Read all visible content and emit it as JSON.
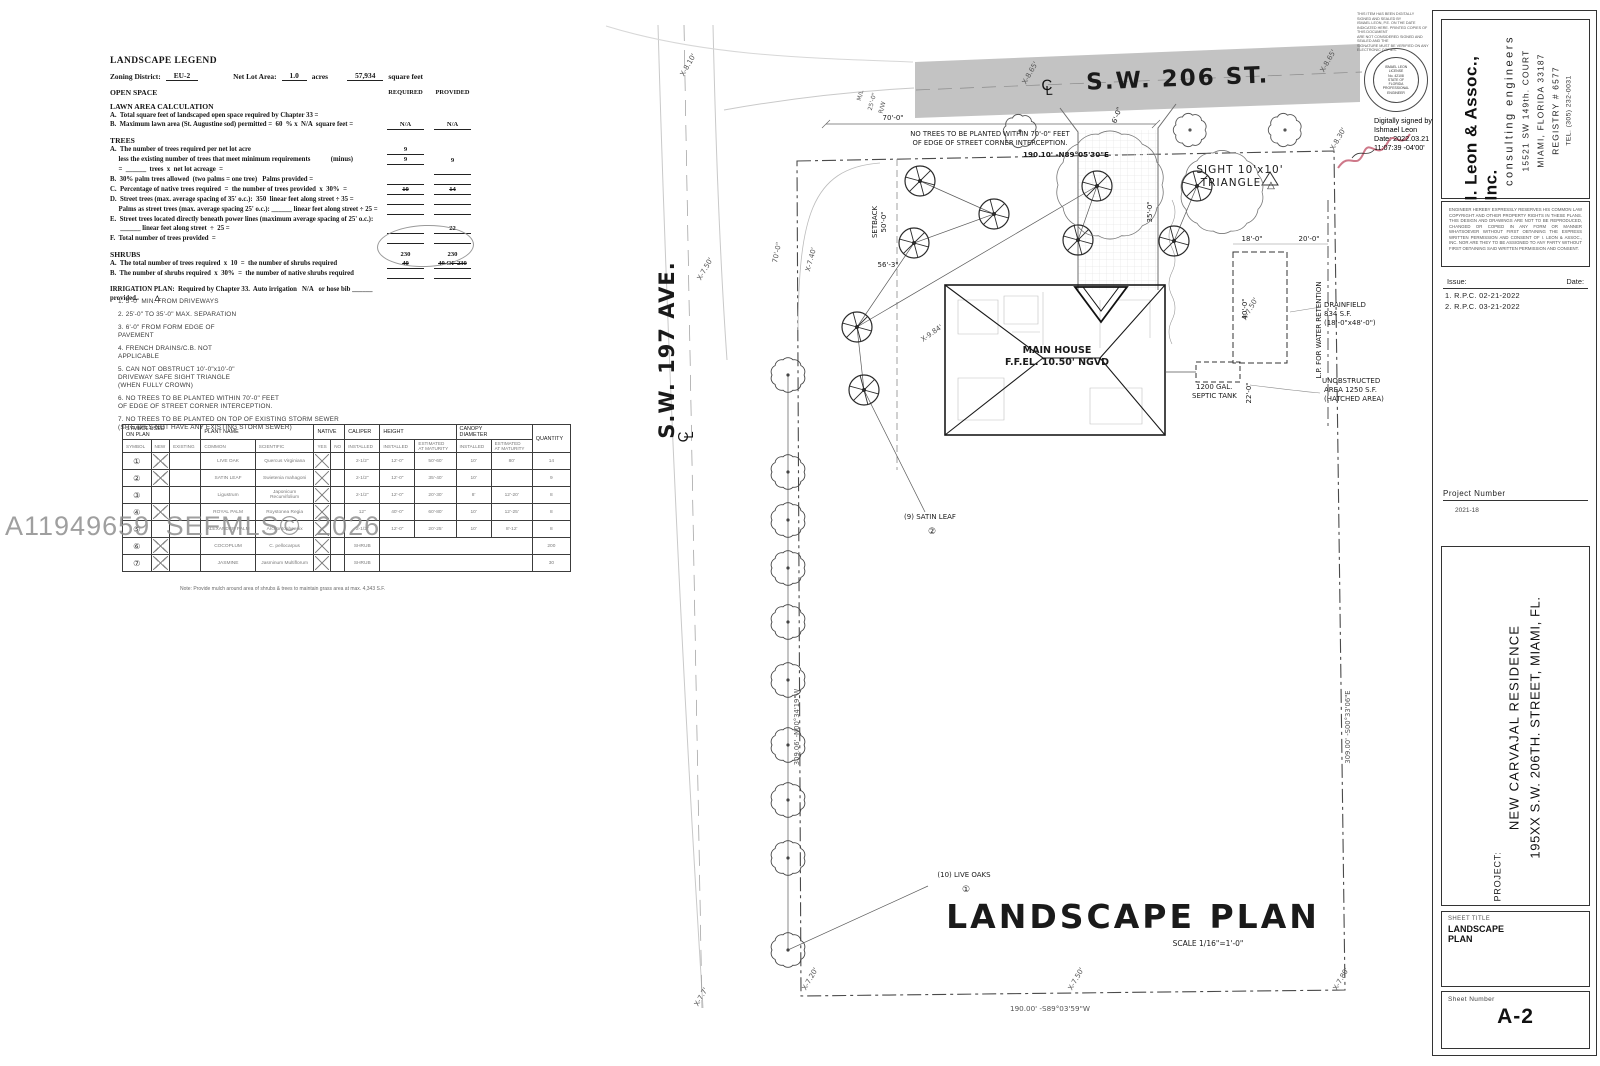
{
  "watermark": "A11949659  SEFMLS© 2026",
  "legend": {
    "title": "LANDSCAPE LEGEND",
    "zoning_label": "Zoning District:",
    "zoning_value": "EU-2",
    "netlot_label": "Net Lot Area:",
    "netlot_acres": "1.0",
    "acres_word": "acres",
    "netlot_sf": "57,934",
    "sf_word": "square feet",
    "rows": [
      {
        "t": "OPEN SPACE",
        "h": 1,
        "hdrR": "REQUIRED",
        "hdrP": "PROVIDED"
      },
      {
        "sp": 5
      },
      {
        "t": "LAWN AREA CALCULATION",
        "h": 1
      },
      {
        "t": "A.  Total square feet of landscaped open space required by Chapter 33 ="
      },
      {
        "t": "B.  Maximum lawn area (St. Augustine sod) permitted =  60  % x  N/A  square feet =",
        "r": "N/A",
        "rl": 1,
        "p": "N/A",
        "pl": 1
      },
      {
        "sp": 6
      },
      {
        "t": "TREES",
        "h": 1
      },
      {
        "t": "A.  The number of trees required per net lot acre",
        "r": "9",
        "rl": 1
      },
      {
        "t": "     less the existing number of trees that meet minimum requirements            (minus)",
        "r": "9",
        "rl": 1,
        "p": "9"
      },
      {
        "t": "     =  ______  trees  x  net lot acreage  =",
        "pl": 1
      },
      {
        "t": "B.  30% palm trees allowed  (two palms = one tree)   Palms provided =",
        "rl": 1,
        "pl": 1
      },
      {
        "t": "C.  Percentage of native trees required  =  the number of trees provided  x  30%  =",
        "r": "10",
        "rl": 1,
        "rs": 1,
        "p": "14",
        "pl": 1,
        "ps": 1
      },
      {
        "t": "D.  Street trees (max. average spacing of 35' o.c.):  350  linear feet along street ÷ 35 =",
        "rl": 1,
        "pl": 1
      },
      {
        "t": "     Palms as street trees (max. average spacing 25' o.c.): ______ linear feet along street ÷ 25 =",
        "rl": 1,
        "pl": 1
      },
      {
        "t": "E.  Street trees located directly beneath power lines (maximum average spacing of 25' o.c.):"
      },
      {
        "t": "      ______ linear feet along street  ÷  25 =",
        "rl": 1,
        "p": "22",
        "pl": 1
      },
      {
        "t": "F.  Total number of trees provided  =",
        "rl": 1,
        "pl": 1
      },
      {
        "sp": 6
      },
      {
        "t": "SHRUBS",
        "h": 1,
        "r": "230",
        "p": "230"
      },
      {
        "t": "A.  The total number of trees required  x  10  =  the number of shrubs required",
        "r": "40",
        "rl": 1,
        "rs": 1,
        "p": "40 OF 230",
        "pl": 1,
        "ps": 1
      },
      {
        "t": "B.  The number of shrubs required  x  30%  =  the number of native shrubs required",
        "rl": 1,
        "pl": 1
      },
      {
        "sp": 6
      },
      {
        "t": "IRRIGATION PLAN:  Required by Chapter 33.  Auto irrigation   N/A   or hose bib ______ provided.          △"
      }
    ]
  },
  "notes": [
    "1. 5'-0\" MIN. FROM DRIVEWAYS",
    "2. 25'-0\" TO 35'-0\" MAX. SEPARATION",
    "3. 6'-0\" FROM FORM EDGE OF\nPAVEMENT",
    "4. FRENCH DRAINS/C.B. NOT\nAPPLICABLE",
    "5. CAN NOT OBSTRUCT 10'-0\"x10'-0\"\nDRIVEWAY SAFE SIGHT TRIANGLE\n(WHEN FULLY CROWN)",
    "6. NO TREES TO BE PLANTED WITHIN 70'-0\" FEET\nOF EDGE OF STREET CORNER INTERCEPTION.",
    "7. NO TREES TO BE PLANTED ON TOP OF EXISTING STORM SEWER\n(SITE DIES NOT HAVE ANY EXISTING STORM SEWER)"
  ],
  "plant_table": {
    "groups": [
      {
        "l": "SYMBOL USED\nON PLAN",
        "c": 3
      },
      {
        "l": "PLANT NAME",
        "c": 2
      },
      {
        "l": "NATIVE",
        "c": 2
      },
      {
        "l": "CALIPER",
        "c": 1
      },
      {
        "l": "HEIGHT",
        "c": 2
      },
      {
        "l": "CANOPY\nDIAMETER",
        "c": 2
      },
      {
        "l": "QUANTITY",
        "c": 1,
        "rs": 2
      }
    ],
    "subheaders": [
      "SYMBOL",
      "NEW",
      "EXISTING",
      "COMMON",
      "SCIENTIFIC",
      "YES",
      "NO",
      "INSTALLED",
      "INSTALLED",
      "ESTIMATED\nAT MATURITY",
      "INSTALLED",
      "ESTIMATED\nAT MATURITY"
    ],
    "rows": [
      [
        "①",
        "X",
        "",
        "LIVE OAK",
        "Quercus Virginiana",
        "X",
        "",
        "2-1/2\"",
        "12'-0\"",
        "50'-60'",
        "10'",
        "80'",
        "14"
      ],
      [
        "②",
        "X",
        "",
        "SATIN LEAF",
        "Swietenia mahagoni",
        "X",
        "",
        "2-1/2\"",
        "12'-0\"",
        "35'-40'",
        "10'",
        "",
        "9"
      ],
      [
        "③",
        "",
        "",
        "Ligustrum",
        "Japonicum\nRecurvifolium",
        "X",
        "",
        "2-1/2\"",
        "12'-0\"",
        "20'-30'",
        "8'",
        "12'-20'",
        "8"
      ],
      [
        "④",
        "X",
        "",
        "ROYAL PALM",
        "Roystonea Regia",
        "X",
        "",
        "12\"",
        "40'-0\"",
        "60'-80'",
        "10'",
        "12'-25'",
        "8"
      ],
      [
        "⑤",
        "",
        "",
        "ALEXANDER PALM",
        "Archontophoenix",
        "X",
        "",
        "2-1/2\"",
        "12'-0\"",
        "20'-25'",
        "10'",
        "8'-12'",
        "8"
      ],
      [
        "⑥",
        "X",
        "",
        "COCOPLUM",
        "C. pellocarpus",
        "X",
        "",
        "SHRUB",
        "",
        "",
        "",
        "",
        "200"
      ],
      [
        "⑦",
        "X",
        "",
        "JASMINE",
        "Jasminum Multiflorum",
        "X",
        "",
        "SHRUB",
        "",
        "",
        "",
        "",
        "30"
      ]
    ],
    "note": "Note: Provide mulch around area of shrubs & trees to maintain grass area at max. 4,343 S.F."
  },
  "plan": {
    "labels": [
      {
        "t": "S.W. 206 ST.",
        "x": 1178,
        "y": 86,
        "s": 23,
        "w": 700,
        "ls": 2,
        "r": -2.3
      },
      {
        "t": "S.W. 197 AVE.",
        "x": 674,
        "y": 350,
        "s": 21,
        "w": 700,
        "ls": 1,
        "r": -90
      },
      {
        "t": "190.10' -N89°05'30\"E",
        "x": 1066,
        "y": 157,
        "s": 7.2,
        "w": 700
      },
      {
        "t": "309.06' -N00°34'19\"W",
        "x": 799,
        "y": 727,
        "s": 6.8,
        "r": -90,
        "f": "#555"
      },
      {
        "t": "309.00' -S00°33'06\"E",
        "x": 1350,
        "y": 727,
        "s": 6.8,
        "r": -90,
        "f": "#555"
      },
      {
        "t": "190.00' -S89°03'59\"W",
        "x": 1050,
        "y": 1011,
        "s": 7.2,
        "f": "#555"
      },
      {
        "t": "NO TREES TO BE PLANTED WITHIN 70'-0\" FEET",
        "x": 990,
        "y": 136,
        "s": 6.8
      },
      {
        "t": "OF EDGE OF STREET CORNER INTERCEPTION.",
        "x": 990,
        "y": 145,
        "s": 6.8
      },
      {
        "t": "70'-0\"",
        "x": 893,
        "y": 120,
        "s": 7
      },
      {
        "t": "SIGHT 10'x10'",
        "x": 1240,
        "y": 173,
        "s": 10.5,
        "ls": 1
      },
      {
        "t": "TRIANGLE",
        "x": 1231,
        "y": 186,
        "s": 10.5,
        "ls": 1
      },
      {
        "t": "△",
        "x": 1271,
        "y": 188,
        "s": 10
      },
      {
        "t": "MAIN HOUSE",
        "x": 1057,
        "y": 353,
        "s": 9.5,
        "w": 700
      },
      {
        "t": "F.F.EL. 10.50' NGVD",
        "x": 1057,
        "y": 365,
        "s": 9.5,
        "w": 700
      },
      {
        "t": "DRAINFIELD",
        "x": 1324,
        "y": 307,
        "s": 7,
        "a": "start"
      },
      {
        "t": "834 S.F.",
        "x": 1324,
        "y": 316,
        "s": 7,
        "a": "start"
      },
      {
        "t": "(18'-0\"x48'-0\")",
        "x": 1324,
        "y": 325,
        "s": 7,
        "a": "start"
      },
      {
        "t": "L.P. FOR WATER RETENTION",
        "x": 1321,
        "y": 330,
        "s": 7,
        "r": -90
      },
      {
        "t": "1200 GAL.",
        "x": 1196,
        "y": 389,
        "s": 7,
        "a": "start"
      },
      {
        "t": "SEPTIC TANK",
        "x": 1192,
        "y": 398,
        "s": 7,
        "a": "start"
      },
      {
        "t": "UNOBSTRUCTED",
        "x": 1322,
        "y": 383,
        "s": 7,
        "a": "start"
      },
      {
        "t": "AREA 1250 S.F.",
        "x": 1324,
        "y": 392,
        "s": 7,
        "a": "start"
      },
      {
        "t": "(HATCHED AREA)",
        "x": 1324,
        "y": 401,
        "s": 7,
        "a": "start"
      },
      {
        "t": "(9) SATIN LEAF",
        "x": 930,
        "y": 519,
        "s": 7
      },
      {
        "t": "②",
        "x": 932,
        "y": 534,
        "s": 9
      },
      {
        "t": "(10) LIVE OAKS",
        "x": 964,
        "y": 877,
        "s": 7
      },
      {
        "t": "①",
        "x": 966,
        "y": 892,
        "s": 9
      },
      {
        "t": "LANDSCAPE PLAN",
        "x": 1133,
        "y": 928,
        "s": 33,
        "w": 700,
        "ls": 3
      },
      {
        "t": "SCALE 1/16\"=1'-0\"",
        "x": 1208,
        "y": 946,
        "s": 7.5
      },
      {
        "t": "X-8.10'",
        "x": 690,
        "y": 66,
        "s": 7,
        "r": -60,
        "f": "#555"
      },
      {
        "t": "X-8.65'",
        "x": 1032,
        "y": 74,
        "s": 7,
        "r": -60,
        "f": "#555"
      },
      {
        "t": "X-8.65'",
        "x": 1330,
        "y": 62,
        "s": 7,
        "r": -60,
        "f": "#555"
      },
      {
        "t": "X-8.30'",
        "x": 1340,
        "y": 140,
        "s": 7,
        "r": -60,
        "f": "#555"
      },
      {
        "t": "X-7.50'",
        "x": 707,
        "y": 270,
        "s": 7,
        "r": -60,
        "f": "#555"
      },
      {
        "t": "X-7.40'",
        "x": 813,
        "y": 260,
        "s": 7,
        "r": -75,
        "f": "#555"
      },
      {
        "t": "X-9.84'",
        "x": 933,
        "y": 335,
        "s": 7,
        "r": -35,
        "f": "#555"
      },
      {
        "t": "X-7.50'",
        "x": 1252,
        "y": 310,
        "s": 7,
        "r": -60,
        "f": "#555"
      },
      {
        "t": "X-7.7'",
        "x": 703,
        "y": 998,
        "s": 7,
        "r": -60,
        "f": "#555"
      },
      {
        "t": "X-7.20'",
        "x": 812,
        "y": 980,
        "s": 7,
        "r": -60,
        "f": "#555"
      },
      {
        "t": "X-7.50'",
        "x": 1078,
        "y": 980,
        "s": 7,
        "r": -60,
        "f": "#555"
      },
      {
        "t": "X-7.80'",
        "x": 1343,
        "y": 980,
        "s": 7,
        "r": -60,
        "f": "#555"
      },
      {
        "t": "56'-3\"",
        "x": 888,
        "y": 267,
        "s": 7
      },
      {
        "t": "50'-0\"",
        "x": 886,
        "y": 222,
        "s": 7,
        "r": -90
      },
      {
        "t": "SETBACK",
        "x": 877,
        "y": 222,
        "s": 7,
        "r": -90
      },
      {
        "t": "70'-0\"",
        "x": 779,
        "y": 253,
        "s": 7,
        "r": -78,
        "f": "#555"
      },
      {
        "t": "35'-0\"",
        "x": 1152,
        "y": 212,
        "s": 7,
        "r": -90
      },
      {
        "t": "6'-0\"",
        "x": 1119,
        "y": 116,
        "s": 7,
        "r": -70
      },
      {
        "t": "M/L",
        "x": 862,
        "y": 96,
        "s": 6,
        "r": -75,
        "f": "#555"
      },
      {
        "t": "25'-0\"",
        "x": 874,
        "y": 102,
        "s": 6,
        "r": -75,
        "f": "#555"
      },
      {
        "t": "R/W",
        "x": 884,
        "y": 108,
        "s": 6,
        "r": -75,
        "f": "#555"
      },
      {
        "t": "18'-0\"",
        "x": 1252,
        "y": 241,
        "s": 7
      },
      {
        "t": "20'-0\"",
        "x": 1309,
        "y": 241,
        "s": 7
      },
      {
        "t": "40'-0\"",
        "x": 1247,
        "y": 309,
        "s": 7,
        "r": -90
      },
      {
        "t": "22'-0\"",
        "x": 1251,
        "y": 393,
        "s": 7,
        "r": -90
      }
    ],
    "cl_symbols": [
      [
        1047,
        90,
        -2
      ],
      [
        688,
        437,
        -90
      ]
    ],
    "satin_leaf_positions": [
      [
        920,
        181
      ],
      [
        994,
        214
      ],
      [
        914,
        243
      ],
      [
        857,
        327
      ],
      [
        864,
        390
      ],
      [
        1097,
        186
      ],
      [
        1197,
        186
      ],
      [
        1078,
        240
      ],
      [
        1174,
        241
      ]
    ],
    "live_oak_positions": [
      [
        788,
        375
      ],
      [
        788,
        472
      ],
      [
        788,
        520
      ],
      [
        788,
        568
      ],
      [
        788,
        622
      ],
      [
        788,
        680
      ],
      [
        788,
        745
      ],
      [
        788,
        800
      ],
      [
        788,
        858
      ],
      [
        788,
        950
      ]
    ],
    "existing_tree_positions": [
      [
        1020,
        131
      ],
      [
        1190,
        130
      ],
      [
        1285,
        130
      ]
    ],
    "canopy_clouds": [
      [
        1110,
        185,
        52
      ],
      [
        1222,
        192,
        40
      ]
    ]
  },
  "titleblock": {
    "company": {
      "name": "I. Leon & Assoc., Inc.",
      "tagline": "consulting engineers",
      "address1": "15521 SW 149th. COURT",
      "address2": "MIAMI, FLORIDA 33187",
      "registry": "REGISTRY # 6577",
      "tel": "TEL. (305) 232-0031"
    },
    "disclaimer": "ENGINEER HEREBY EXPRESSLY RESERVES HIS COMMON LAW COPYRIGHT AND OTHER PROPERTY RIGHTS IN THESE PLANS. THIS DESIGN AND DRAWINGS ARE NOT TO BE REPRODUCED, CHANGED OR COPIED IN ANY FORM OR MANNER WHATSOEVER WITHOUT FIRST OBTAINING THE EXPRESS WRITTEN PERMISSION AND CONSENT OF I. LEON & ASSOC., INC. NOR ARE THEY TO BE ASSIGNED TO ANY PARTY WITHOUT FIRST OBTAINING SAID WRITTEN PERMISSION AND CONSENT.",
    "issue_label": "Issue:",
    "date_label": "Date:",
    "issues": [
      "1.  R.P.C.  02-21-2022",
      "2.  R.P.C.  03-21-2022"
    ],
    "project_number_label": "Project Number",
    "project_number": "2021-18",
    "project_label": "PROJECT:",
    "project_line1": "NEW CARVAJAL RESIDENCE",
    "project_line2": "195XX S.W. 206TH. STREET, MIAMI, FL.",
    "sheet_title_label": "SHEET TITLE",
    "sheet_title": "LANDSCAPE PLAN",
    "sheet_number_label": "Sheet Number",
    "sheet_number": "A-2"
  },
  "stamp": {
    "cert_text": "THIS ITEM HAS BEEN DIGITALLY\nSIGNED AND SEALED BY\nISMAEL LEON, P.E. ON THE DATE\nINDICATED HERE. PRINTED COPIES OF THIS DOCUMENT\nARE NOT CONSIDERED SIGNED AND SEALED AND THE\nSIGNATURE MUST BE VERIFIED ON ANY ELECTRONIC COPIES.",
    "seal_lines": [
      "ISMAEL LEON",
      "LICENSE",
      "No. 42108",
      "STATE OF",
      "FLORIDA",
      "PROFESSIONAL ENGINEER"
    ],
    "digital_text": "Digitally signed by Ishmael Leon Date: 2022.03.21 11:07:39 -04'00'"
  }
}
